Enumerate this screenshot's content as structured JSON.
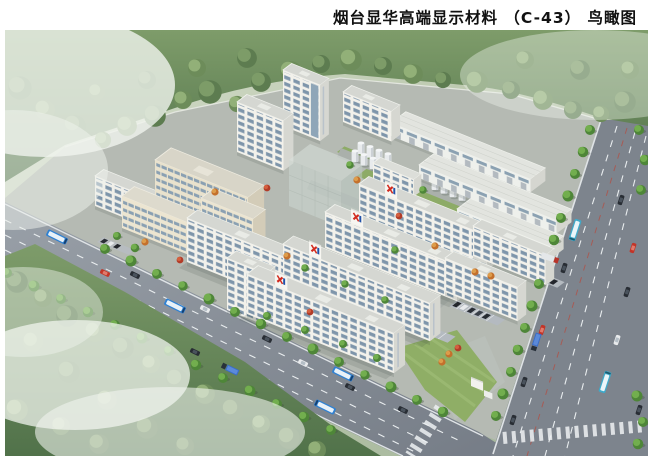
{
  "page": {
    "title": "烟台显华高端显示材料 （C-43） 鸟瞰图",
    "title_color": "#111111",
    "background": "#ffffff"
  },
  "scene": {
    "kind": "aerial bird's-eye architectural rendering of an industrial campus with roads, forest, dormitory slabs, warehouses and storage tanks",
    "logo": {
      "red": "#d22a1e",
      "blue": "#2151a8"
    },
    "palette": {
      "forest_dark": "#4c6b43",
      "forest_light": "#87a671",
      "street_tree": "#5f9e46",
      "lawn": "#8dab67",
      "road_asphalt": "#868d95",
      "lane_marking": "#e9edef",
      "campus_paving": "#b5bab3",
      "building_wall": "#f2f1eb",
      "building_window": "#7e95aa",
      "building_roof": "#d5d7d2",
      "admin_wall": "#e9e2cd",
      "ghost_building": "#cdd8d2",
      "tank_white": "#e8ebed",
      "mist_white": "#f0f4ee",
      "bus_blue": "#2f81d2",
      "bus_teal": "#3fa9c9",
      "truck_blue": "#3a6cc8",
      "car_red": "#c23528"
    }
  }
}
